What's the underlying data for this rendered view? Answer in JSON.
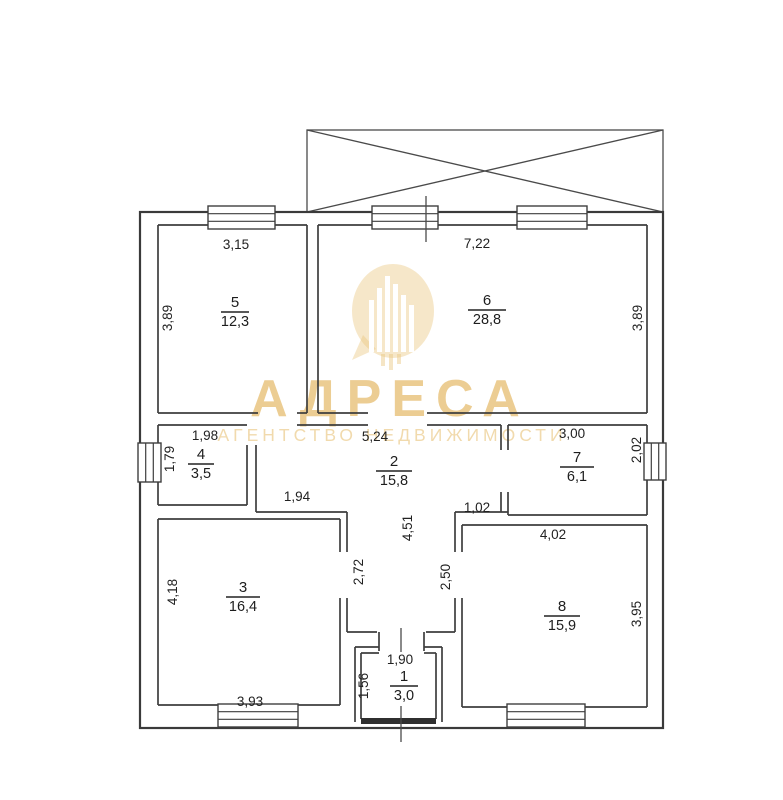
{
  "watermark": {
    "brand": "АДРЕСА",
    "tagline": "АГЕНТСТВО НЕДВИЖИМОСТИ",
    "accent_color": "#e7bf74"
  },
  "rooms": [
    {
      "number": "5",
      "area": "12,3"
    },
    {
      "number": "6",
      "area": "28,8"
    },
    {
      "number": "4",
      "area": "3,5"
    },
    {
      "number": "2",
      "area": "15,8"
    },
    {
      "number": "7",
      "area": "6,1"
    },
    {
      "number": "3",
      "area": "16,4"
    },
    {
      "number": "8",
      "area": "15,9"
    },
    {
      "number": "1",
      "area": "3,0"
    }
  ],
  "dimensions": [
    {
      "value": "3,15"
    },
    {
      "value": "7,22"
    },
    {
      "value": "3,89"
    },
    {
      "value": "3,89"
    },
    {
      "value": "1,98"
    },
    {
      "value": "5,24"
    },
    {
      "value": "3,00"
    },
    {
      "value": "1,79"
    },
    {
      "value": "2,02"
    },
    {
      "value": "1,94"
    },
    {
      "value": "1,02"
    },
    {
      "value": "4,51"
    },
    {
      "value": "2,72"
    },
    {
      "value": "2,50"
    },
    {
      "value": "4,02"
    },
    {
      "value": "4,18"
    },
    {
      "value": "3,95"
    },
    {
      "value": "3,93"
    },
    {
      "value": "1,90"
    },
    {
      "value": "1,56"
    }
  ]
}
